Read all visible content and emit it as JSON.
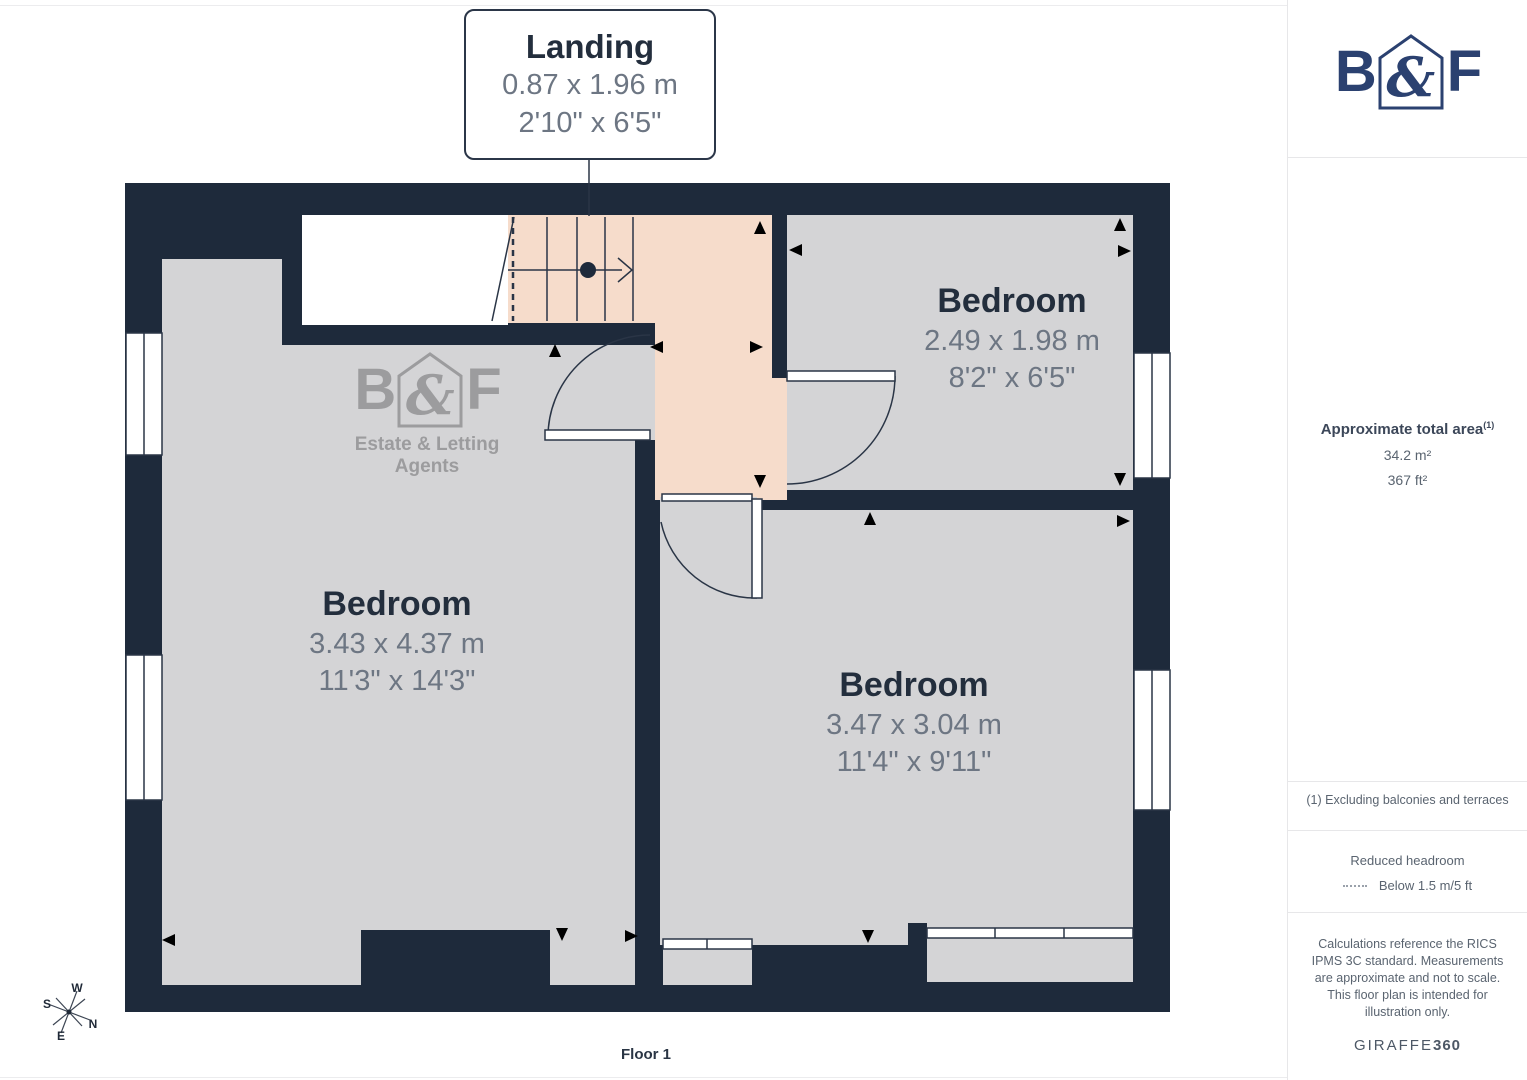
{
  "floorplan": {
    "floor_label": "Floor 1",
    "landing": {
      "name": "Landing",
      "metric": "0.87 x 1.96 m",
      "imperial": "2'10\" x 6'5\""
    },
    "rooms": [
      {
        "name": "Bedroom",
        "metric": "2.49 x 1.98 m",
        "imperial": "8'2\" x 6'5\""
      },
      {
        "name": "Bedroom",
        "metric": "3.43 x 4.37 m",
        "imperial": "11'3\" x 14'3\""
      },
      {
        "name": "Bedroom",
        "metric": "3.47 x 3.04 m",
        "imperial": "11'4\" x 9'11\""
      }
    ],
    "compass": {
      "n": "N",
      "s": "S",
      "e": "E",
      "w": "W"
    },
    "watermark": {
      "b": "B",
      "amp": "&",
      "f": "F",
      "tagline": "Estate & Letting Agents"
    }
  },
  "sidebar": {
    "logo": {
      "b": "B",
      "amp": "&",
      "f": "F"
    },
    "area": {
      "title": "Approximate total area",
      "superscript": "(1)",
      "metric": "34.2 m²",
      "imperial": "367 ft²"
    },
    "footnote": "(1) Excluding balconies and terraces",
    "legend": {
      "title": "Reduced headroom",
      "item": "Below 1.5 m/5 ft"
    },
    "disclaimer": "Calculations reference the RICS IPMS 3C standard. Measurements are approximate and not to scale. This floor plan is intended for illustration only.",
    "brand": {
      "name": "GIRAFFE",
      "suffix": "360"
    }
  },
  "colors": {
    "wall": "#1e2a3b",
    "floor": "#d4d4d6",
    "landing": "#f6dccb",
    "line": "#2a3546",
    "logoNavy": "#2b4170",
    "watermark": "#9c9c9e",
    "roomName": "#232e3d",
    "roomDim": "#6d7683",
    "sidebarTitle": "#3c4759",
    "sidebarText": "#5a6470",
    "divider": "#e7e7e9",
    "calloutBorder": "#2b3648"
  }
}
